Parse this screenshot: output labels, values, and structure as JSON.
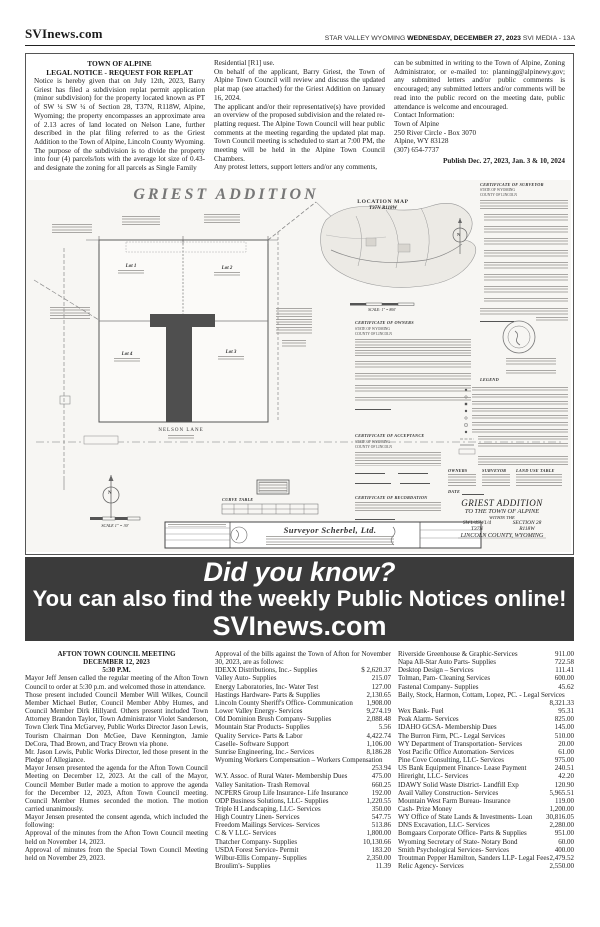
{
  "masthead": {
    "brand": "SVInews.com",
    "right_plain1": "STAR VALLEY WYOMING ",
    "right_bold": "WEDNESDAY, DECEMBER 27, 2023",
    "right_plain2": " SVI MEDIA - 13A"
  },
  "notice": {
    "title1": "TOWN OF ALPINE",
    "title2": "LEGAL NOTICE - REQUEST FOR REPLAT",
    "col1": [
      "Notice is hereby given that on July 12th, 2023, Barry Griest has filed a subdivision replat permit application (minor subdivision) for the property located known as PT of SW ¼ SW ¼ of Section 28, T37N, R118W, Alpine, Wyoming; the property encompasses an approximate area of 2.13 acres of land located on Nelson Lane, further described in the plat filing referred to as the Griest Addition to the Town of Alpine, Lincoln County Wyoming.",
      "The purpose of the subdivision is to divide the property into four (4) parcels/lots with the average lot size of 0.43- and designate the zoning for all parcels as Single Family"
    ],
    "col2": [
      "Residential [R1] use.",
      "On behalf of the applicant, Barry Griest, the Town of Alpine Town Council will review and discuss the updated plat map (see attached) for the Griest Addition on January 16, 2024.",
      "The applicant and/or their representative(s) have provided an overview of the proposed subdivision and the related re-platting request. The Alpine Town Council will hear public comments at the meeting regarding the updated plat map.  Town Council meeting is scheduled to start at 7:00 PM, the meeting will be held in the Alpine Town Council Chambers.",
      "Any protest letters, support letters and/or any comments,"
    ],
    "col3_p1": "can be submitted in writing to the Town of Alpine, Zoning Administrator, or e-mailed to: planning@alpinewy.gov; any submitted letters and/or public comments is encouraged; any submitted letters and/or comments will be read into the public record on the meeting date, public attendance is welcome and encouraged.",
    "contact": [
      "Contact Information:",
      "Town of Alpine",
      "250 River Circle - Box 3070",
      "Alpine, WY 83128",
      "(307) 654-7737"
    ],
    "publish": "Publish Dec. 27, 2023, Jan. 3 & 10, 2024"
  },
  "plat": {
    "title": "GRIEST ADDITION",
    "location_map_title": "LOCATION MAP",
    "location_map_sub": "T37N  R118W",
    "lot1": "Lot 1",
    "lot2": "Lot 2",
    "lot3": "Lot 3",
    "lot4": "Lot 4",
    "road_label": "NELSON LANE",
    "cert_surveyor": "CERTIFICATE OF SURVEYOR",
    "cert_owners": "CERTIFICATE OF OWNERS",
    "cert_acceptance": "CERTIFICATE OF ACCEPTANCE",
    "cert_recordation": "CERTIFICATE OF RECORDATION",
    "state_line": "STATE OF WYOMING",
    "county_line": "COUNTY OF LINCOLN",
    "legend_title": "LEGEND",
    "curve_table_title": "CURVE TABLE",
    "owners_label": "OWNERS",
    "surveyor_label": "SURVEYOR",
    "land_use_label": "LAND USE TABLE",
    "date_label": "DATE",
    "north_letter": "N",
    "scale_main": "SCALE  1\" = 30'",
    "scale_location": "SCALE: 1\" = 800'",
    "firm_name": "Surveyor Scherbel, Ltd.",
    "title_block": {
      "line1": "GRIEST ADDITION",
      "line2": "TO THE TOWN OF ALPINE",
      "line3": "WITHIN THE",
      "line4a": "SW1/4SW1/4",
      "line4b": "SECTION 28",
      "line5a": "T37N",
      "line5b": "R118W",
      "line6": "LINCOLN COUNTY, WYOMING"
    }
  },
  "banner": {
    "line1": "Did you know?",
    "line2": "You can also find the weekly Public Notices online!",
    "line3": "SVInews.com"
  },
  "council": {
    "title1": "AFTON TOWN COUNCIL MEETING",
    "title2": "DECEMBER 12, 2023",
    "title3": "5:30 P.M.",
    "paragraphs": [
      "Mayor Jeff Jensen called the regular meeting of the Afton Town Council to order at 5:30 p.m. and welcomed those in attendance.",
      "Those present included Council Member Will Wilkes, Council Member Michael Butler, Council Member Abby Humes, and Council Member Dirk Hillyard. Others present included Town Attorney Brandon Taylor, Town Administrator Violet Sanderson, Town Clerk Tina McGarvey, Public Works Director Jason Lewis, Tourism Chairman Don McGee, Dave Kennington, Jamie DeCora, Thad Brown, and Tracy Brown via phone.",
      "Mr. Jason Lewis, Public Works Director, led those present in the Pledge of Allegiance.",
      "Mayor Jensen presented the agenda for the Afton Town Council Meeting on December 12, 2023. At the call of the Mayor, Council Member Butler made a motion to approve the agenda for the December 12, 2023, Afton Town Council meeting. Council Member Humes seconded the motion. The motion carried unanimously.",
      "Mayor Jensen presented the consent agenda, which included the following:",
      "Approval of the minutes from the Afton Town Council meeting held on November 14, 2023.",
      "Approval of minutes from the Special Town Council Meeting held on November 29, 2023."
    ],
    "bills_intro": "Approval of the bills against the Town of Afton for November 30, 2023, are as follows:",
    "bills_col2": [
      {
        "name": "IDEXX Distributions, Inc.- Supplies",
        "amount": "$    2,620.37"
      },
      {
        "name": "Valley Auto- Supplies",
        "amount": "215.07"
      },
      {
        "name": "Energy Laboratories, Inc- Water Test",
        "amount": "127.00"
      },
      {
        "name": "Hastings Hardware- Parts & Supplies",
        "amount": "2,130.65"
      },
      {
        "name": "Lincoln County Sheriff's Office- Communication",
        "amount": "1,908.00"
      },
      {
        "name": "Lower Valley Energy- Services",
        "amount": "9,274.19"
      },
      {
        "name": "Old Dominion Brush Company- Supplies",
        "amount": "2,088.48"
      },
      {
        "name": "Mountain Star Products- Supplies",
        "amount": "5.56"
      },
      {
        "name": "Quality Service- Parts & Labor",
        "amount": "4,422.74"
      },
      {
        "name": "Caselle- Software Support",
        "amount": "1,106.00"
      },
      {
        "name": "Sunrise Engineering, Inc.- Services",
        "amount": "8,186.28"
      },
      {
        "name": "Wyoming Workers Compensation – Workers Compensation",
        "amount": "253.94"
      },
      {
        "name": "W.Y. Assoc. of Rural Water- Membership Dues",
        "amount": "475.00"
      },
      {
        "name": "Valley Sanitation- Trash Removal",
        "amount": "660.25"
      },
      {
        "name": "NCPERS Group Life Insurance- Life Insurance",
        "amount": "192.00"
      },
      {
        "name": "ODP Business Solutions, LLC- Supplies",
        "amount": "1,220.55"
      },
      {
        "name": "Triple H Landscaping, LLC- Services",
        "amount": "350.00"
      },
      {
        "name": "High Country Linen- Services",
        "amount": "547.75"
      },
      {
        "name": "Freedom Mailings Services- Services",
        "amount": "513.86"
      },
      {
        "name": "C & V LLC- Services",
        "amount": "1,800.00"
      },
      {
        "name": "Thatcher Company- Supplies",
        "amount": "10,130.66"
      },
      {
        "name": "USDA Forest Service- Permit",
        "amount": "183.20"
      },
      {
        "name": "Wilbur-Ellis Company- Supplies",
        "amount": "2,350.00"
      },
      {
        "name": "Broulim's- Supplies",
        "amount": "11.39"
      }
    ],
    "bills_col3": [
      {
        "name": "Riverside Greenhouse & Graphic-Services",
        "amount": "911.00"
      },
      {
        "name": "Napa All-Star Auto Parts- Supplies",
        "amount": "722.58"
      },
      {
        "name": "Desktop Design – Services",
        "amount": "111.41"
      },
      {
        "name": "Tolman, Pam- Cleaning Services",
        "amount": "600.00"
      },
      {
        "name": "Fastenal Company- Supplies",
        "amount": "45.62"
      },
      {
        "name": "Baily, Stock, Harmon, Cottam, Lopez, PC. - Legal Services",
        "amount": "8,321.33"
      },
      {
        "name": "Wex Bank- Fuel",
        "amount": "95.31"
      },
      {
        "name": "Peak Alarm- Services",
        "amount": "825.00"
      },
      {
        "name": "IDAHO GCSA- Membership Dues",
        "amount": "145.00"
      },
      {
        "name": "The Burron Firm, PC.- Legal Services",
        "amount": "510.00"
      },
      {
        "name": "WY Department of Transportation- Services",
        "amount": "20.00"
      },
      {
        "name": "Yost Pacific Office Automation- Services",
        "amount": "61.00"
      },
      {
        "name": "Pine Cove Consulting, LLC- Services",
        "amount": "975.00"
      },
      {
        "name": "US Bank Equipment Finance- Lease Payment",
        "amount": "240.51"
      },
      {
        "name": "Hireright, LLC- Services",
        "amount": "42.20"
      },
      {
        "name": "IDAWY Solid Waste District- Landfill Exp",
        "amount": "120.90"
      },
      {
        "name": "Avail Valley Construction- Services",
        "amount": "5,965.51"
      },
      {
        "name": "Mountain West Farm Bureau- Insurance",
        "amount": "119.00"
      },
      {
        "name": "Cash- Prize Money",
        "amount": "1,200.00"
      },
      {
        "name": "WY Office of State Lands & Investments- Loan",
        "amount": "30,816.05"
      },
      {
        "name": "DNS Excavation, LLC- Services",
        "amount": "2,280.00"
      },
      {
        "name": "Bomgaars Corporate Office- Parts & Supplies",
        "amount": "951.00"
      },
      {
        "name": "Wyoming Secretary of State- Notary Bond",
        "amount": "60.00"
      },
      {
        "name": "Smith Psychological Services- Services",
        "amount": "400.00"
      },
      {
        "name": "Troutman Pepper Hamilton, Sanders LLP- Legal Fees",
        "amount": "2,479.52"
      },
      {
        "name": "Relic Agency- Services",
        "amount": "2,550.00"
      }
    ]
  }
}
